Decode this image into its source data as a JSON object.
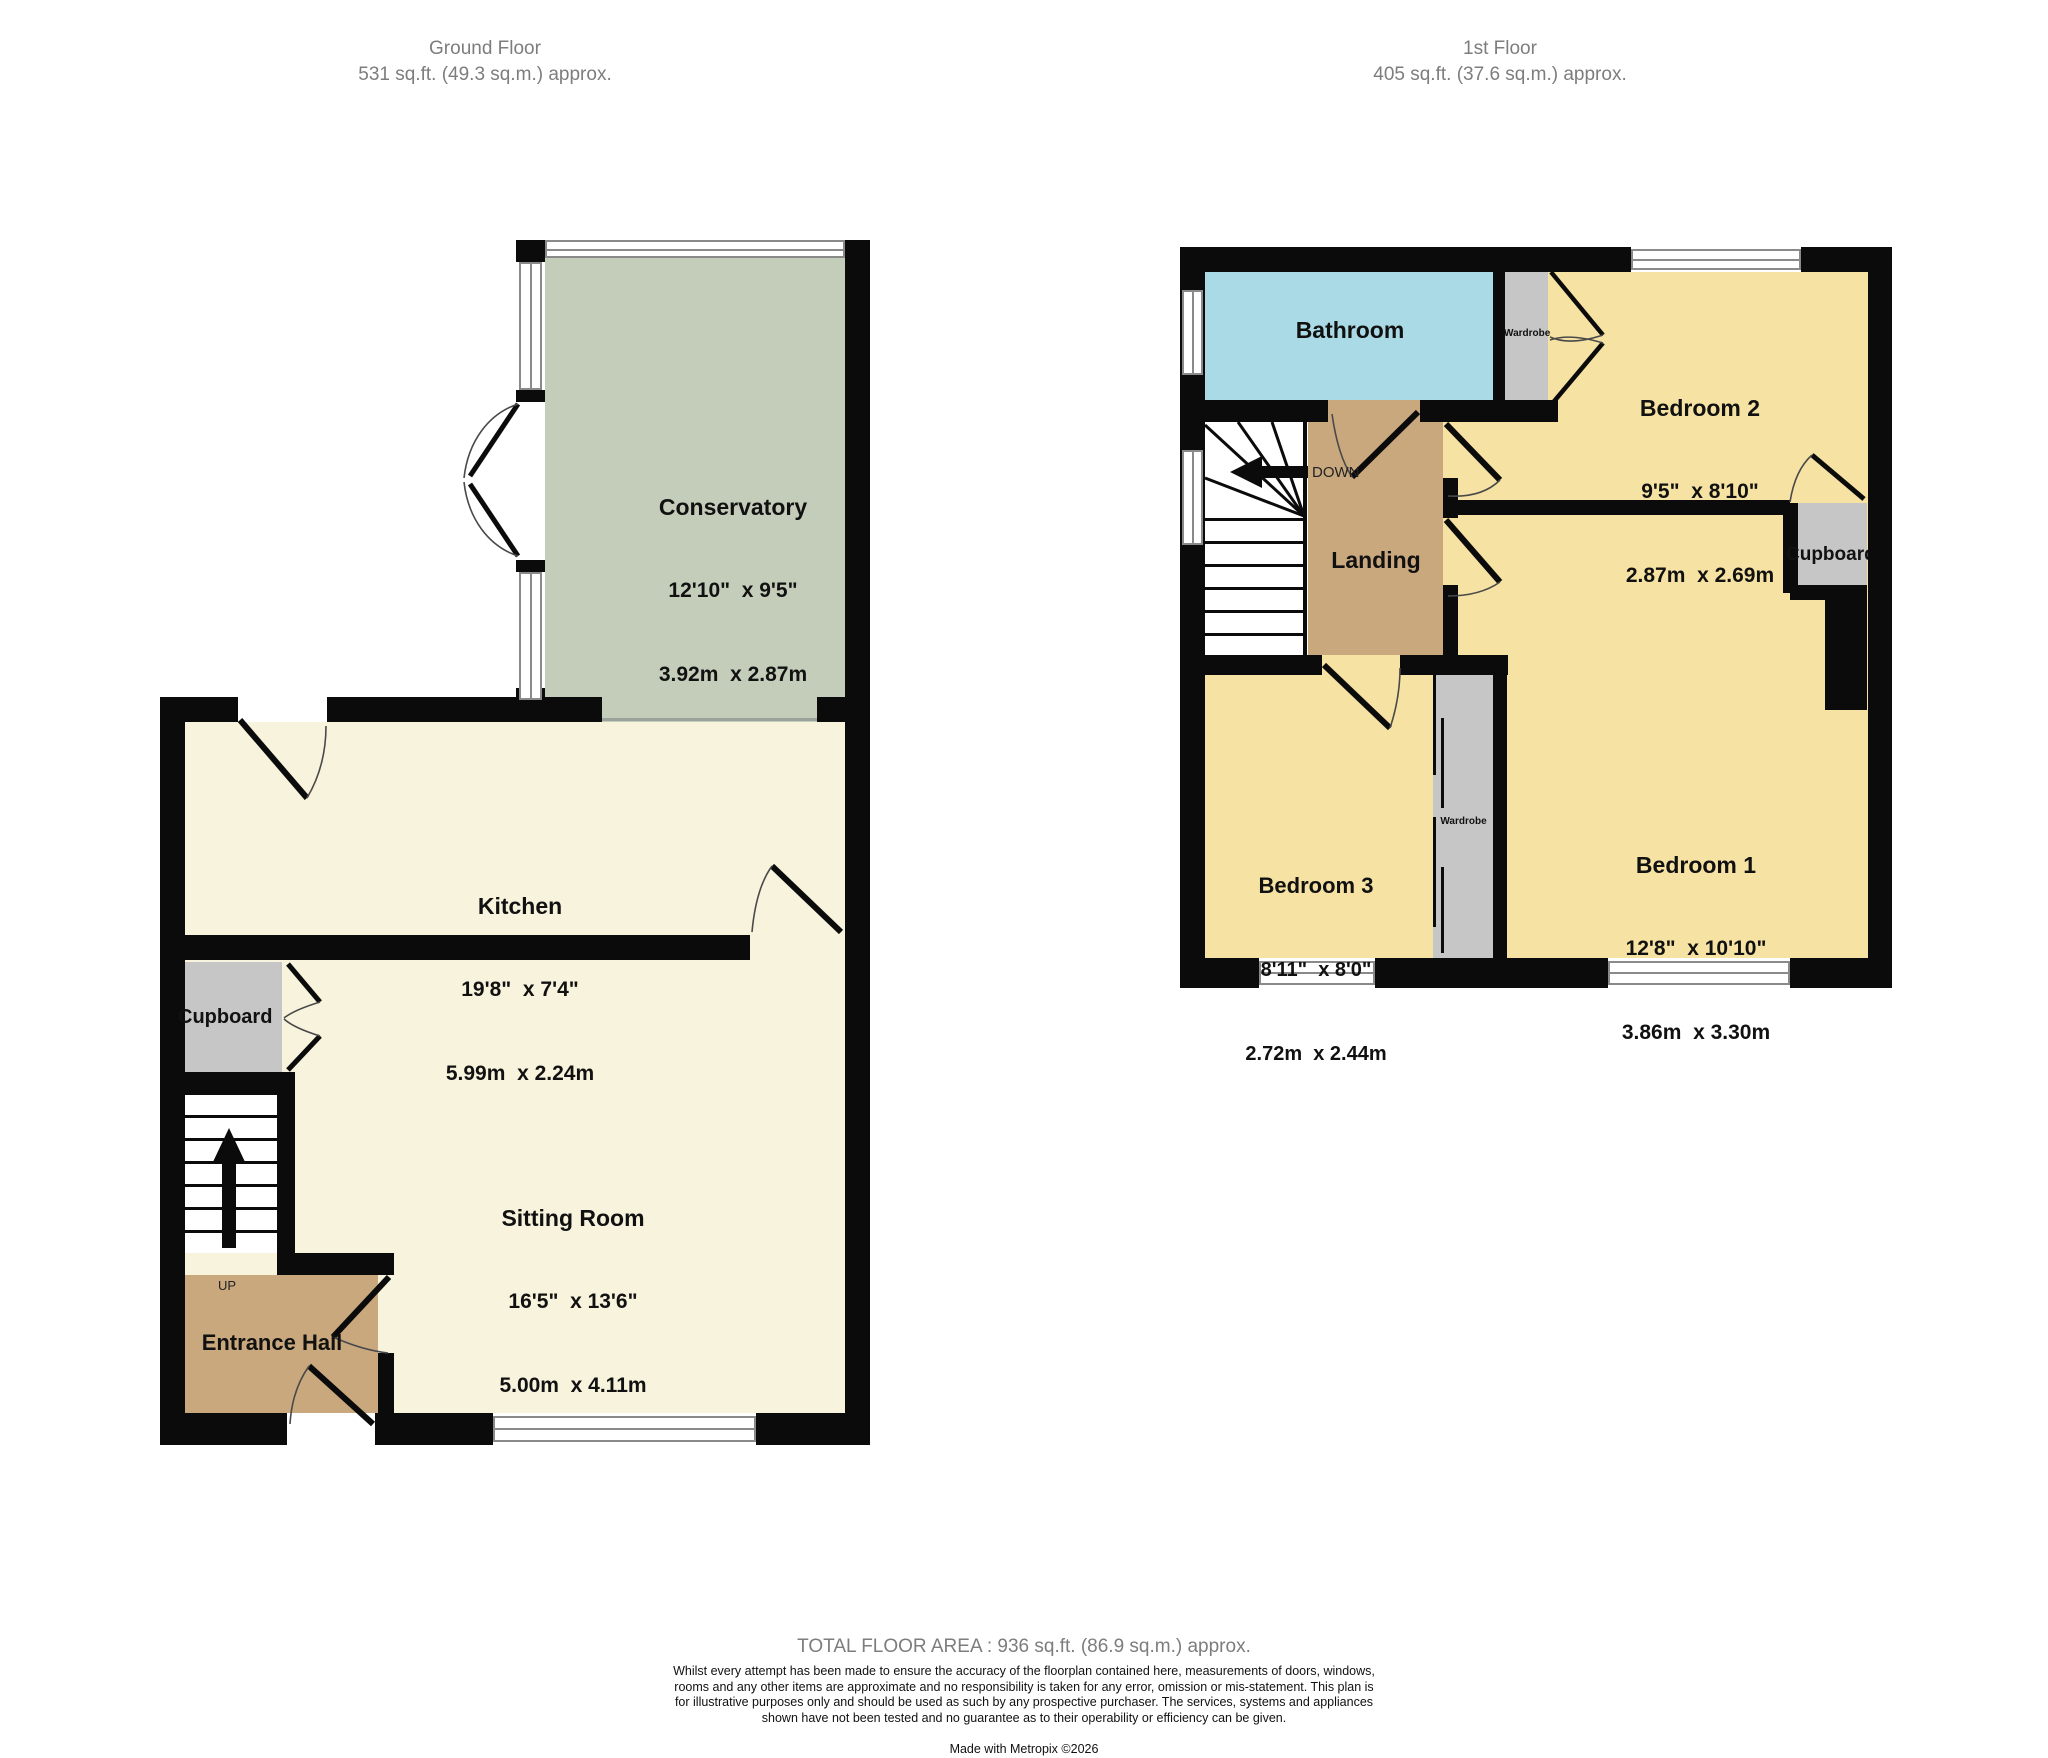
{
  "ground_floor": {
    "title": "Ground Floor",
    "area": "531 sq.ft. (49.3 sq.m.) approx.",
    "stairs_label": "UP",
    "rooms": {
      "conservatory": {
        "name": "Conservatory",
        "imperial": "12'10\"  x 9'5\"",
        "metric": "3.92m  x 2.87m"
      },
      "kitchen": {
        "name": "Kitchen",
        "imperial": "19'8\"  x 7'4\"",
        "metric": "5.99m  x 2.24m"
      },
      "sitting_room": {
        "name": "Sitting Room",
        "imperial": "16'5\"  x 13'6\"",
        "metric": "5.00m  x 4.11m"
      },
      "entrance_hall": {
        "name": "Entrance Hall"
      },
      "cupboard": {
        "name": "Cupboard"
      }
    }
  },
  "first_floor": {
    "title": "1st Floor",
    "area": "405 sq.ft. (37.6 sq.m.) approx.",
    "stairs_label": "DOWN",
    "rooms": {
      "bathroom": {
        "name": "Bathroom"
      },
      "bedroom2": {
        "name": "Bedroom 2",
        "imperial": "9'5\"  x 8'10\"",
        "metric": "2.87m  x 2.69m"
      },
      "bedroom1": {
        "name": "Bedroom 1",
        "imperial": "12'8\"  x 10'10\"",
        "metric": "3.86m  x 3.30m"
      },
      "bedroom3": {
        "name": "Bedroom 3",
        "imperial": "8'11\"  x 8'0\"",
        "metric": "2.72m  x 2.44m"
      },
      "landing": {
        "name": "Landing"
      },
      "cupboard": {
        "name": "Cupboard"
      },
      "wardrobe_top": {
        "name": "Wardrobe"
      },
      "wardrobe_bottom": {
        "name": "Wardrobe"
      }
    }
  },
  "footer": {
    "total": "TOTAL FLOOR AREA : 936 sq.ft. (86.9 sq.m.) approx.",
    "disclaimer": "Whilst every attempt has been made to ensure the accuracy of the floorplan contained here, measurements of doors, windows, rooms and any other items are approximate and no responsibility is taken for any error, omission or mis-statement. This plan is for illustrative purposes only and should be used as such by any prospective purchaser. The services, systems and appliances shown have not been tested and no guarantee as to their operability or efficiency can be given.",
    "credit": "Made with Metropix ©2026"
  },
  "colors": {
    "wall": "#0b0b0b",
    "cream": "#f8f3dc",
    "sage": "#c4cdba",
    "yellow": "#f6e2a3",
    "tan": "#c9a87e",
    "blue": "#aadae6",
    "gray": "#c6c6c6",
    "title_gray": "#7d7d7d"
  }
}
